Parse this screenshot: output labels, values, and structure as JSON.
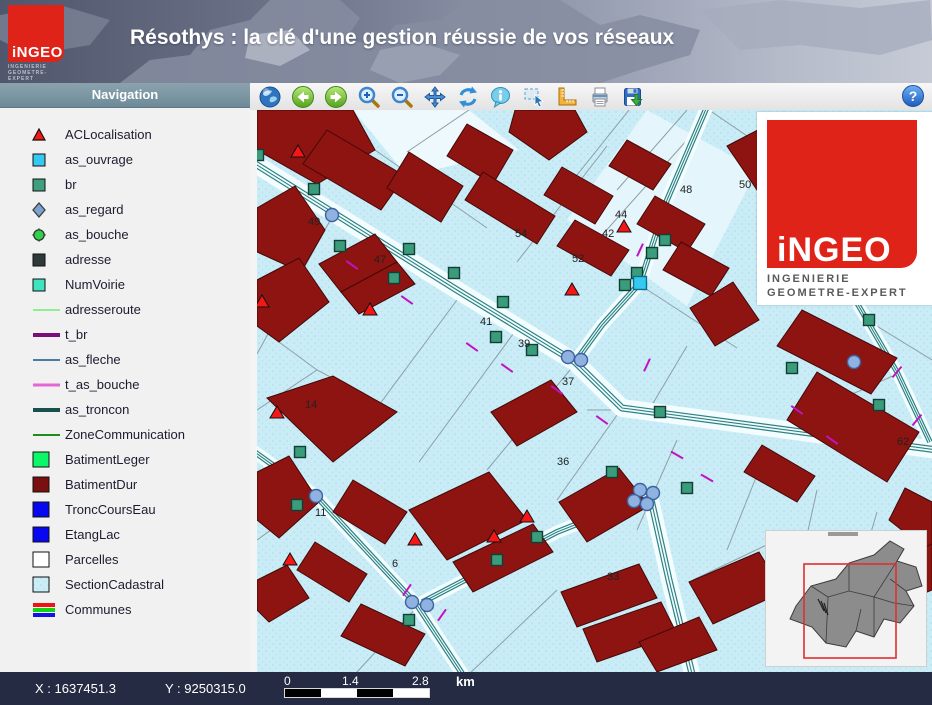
{
  "header": {
    "title": "Résothys : la clé d'une gestion réussie de vos réseaux",
    "logo": {
      "name": "iNGEO",
      "subline1": "INGENIERIE",
      "subline2": "GEOMETRE-EXPERT"
    }
  },
  "sidebar": {
    "title": "Navigation",
    "items": [
      {
        "label": "ACLocalisation",
        "icon": "triangle-red"
      },
      {
        "label": "as_ouvrage",
        "icon": "square-cyan"
      },
      {
        "label": "br",
        "icon": "square-teal"
      },
      {
        "label": "as_regard",
        "icon": "diamond-steelblue"
      },
      {
        "label": "as_bouche",
        "icon": "node-green"
      },
      {
        "label": "adresse",
        "icon": "square-darkgray"
      },
      {
        "label": "NumVoirie",
        "icon": "square-turquoise"
      },
      {
        "label": "adresseroute",
        "icon": "line-lightgreen"
      },
      {
        "label": "t_br",
        "icon": "line-purple"
      },
      {
        "label": "as_fleche",
        "icon": "line-steelblue"
      },
      {
        "label": "t_as_bouche",
        "icon": "line-pink"
      },
      {
        "label": "as_troncon",
        "icon": "line-darkteal"
      },
      {
        "label": "ZoneCommunication",
        "icon": "line-green"
      },
      {
        "label": "BatimentLeger",
        "icon": "square-brightgreen"
      },
      {
        "label": "BatimentDur",
        "icon": "square-darkred"
      },
      {
        "label": "TroncCoursEau",
        "icon": "square-blue"
      },
      {
        "label": "EtangLac",
        "icon": "square-blue"
      },
      {
        "label": "Parcelles",
        "icon": "square-white"
      },
      {
        "label": "SectionCadastral",
        "icon": "square-stipple"
      },
      {
        "label": "Communes",
        "icon": "stripes-rgb"
      }
    ]
  },
  "toolbar": {
    "buttons": [
      {
        "name": "globe"
      },
      {
        "name": "back"
      },
      {
        "name": "forward"
      },
      {
        "name": "zoom-in"
      },
      {
        "name": "zoom-out"
      },
      {
        "name": "pan"
      },
      {
        "name": "refresh"
      },
      {
        "name": "info"
      },
      {
        "name": "select"
      },
      {
        "name": "measure"
      },
      {
        "name": "print"
      },
      {
        "name": "save"
      }
    ],
    "help": {
      "name": "help",
      "glyph": "?"
    }
  },
  "map": {
    "logo_overlay": {
      "name": "iNGEO",
      "subline1": "INGENIERIE",
      "subline2": "GEOMETRE-EXPERT"
    },
    "colors": {
      "background": "#c9ecf6",
      "stipple": "#a8dcea",
      "building": "#8d1411",
      "building_edge": "#430808",
      "parcel": "#8f9ea6",
      "road_fill": "#f3fcfe",
      "road_line": "#2b8282",
      "tick": "#c213c3",
      "br_square": "#3b9c7c",
      "regard_circle": "#8fb2e0",
      "triangle": "#f51616",
      "ouvrage": "#35c9ef",
      "label": "#222222"
    },
    "roads": [
      {
        "d": "M-8,50 L200,180 L318,252 L365,298 L680,340",
        "w": 18
      },
      {
        "d": "M452,-8 L410,90 L383,173 L345,215 L318,252",
        "w": 13
      },
      {
        "d": "M393,385 L412,470 L436,568",
        "w": 16
      },
      {
        "d": "M393,385 L300,422 L160,495",
        "w": 13
      },
      {
        "d": "M-8,338 L59,386 L160,495 L208,568",
        "w": 13
      },
      {
        "d": "M600,193 L640,262 L673,332",
        "w": 12
      }
    ],
    "parcels": [
      "M150,42 L212,0",
      "M260,152 L350,36",
      "M330,142 L430,30",
      "M300,90 L372,0",
      "M430,0 L360,80",
      "M75,107 L0,244",
      "M200,190 L96,330",
      "M262,216 L162,352",
      "M318,254 L230,360",
      "M365,298 L300,390",
      "M420,330 L380,420",
      "M500,365 L470,440",
      "M560,380 L540,470",
      "M620,402 L600,470",
      "M452,0 L540,60 L600,190",
      "M383,175 L480,238",
      "M430,236 L392,300 L330,300",
      "M0,300 L60,260",
      "M160,497 L100,562",
      "M208,568 L300,480",
      "M436,470 L520,430",
      "M59,388 L0,430",
      "M675,250 L610,210",
      "M640,264 L560,300",
      "M500,80 L560,120 L600,193",
      "M118,40 L230,118",
      "M22,232 L60,260 L140,302"
    ],
    "buildings": [
      "0,0 96,0 118,40 60,74 0,40",
      "70,20 148,66 124,100 46,54",
      "152,42 206,76 184,112 130,78",
      "210,14 256,40 236,74 190,46",
      "226,62 298,106 280,134 208,90",
      "258,0 318,0 330,22 292,50 252,22",
      "305,57 356,86 338,114 287,85",
      "318,110 372,140 354,166 300,136",
      "370,30 414,54 396,80 352,56",
      "398,86 448,114 430,142 380,114",
      "424,132 472,158 454,186 406,160",
      "470,36 520,10 548,52 500,80",
      "433,198 476,172 502,210 458,236",
      "545,200 640,248 614,284 520,236",
      "560,262 662,322 630,372 530,310",
      "648,378 675,392 675,444 632,410",
      "505,335 558,366 540,392 487,362",
      "0,98 38,76 68,120 44,162 0,142",
      "0,170 42,148 72,192 22,232 0,216",
      "62,154 118,124 140,152 84,182",
      "84,182 140,152 158,174 102,204",
      "10,288 76,266 140,302 76,352",
      "0,362 32,346 62,392 22,428 0,410",
      "96,370 150,402 128,434 76,402",
      "58,432 110,464 92,492 40,460",
      "104,494 168,524 148,556 84,526",
      "152,400 232,362 270,410 190,450",
      "196,452 276,414 296,442 216,482",
      "234,302 294,270 320,302 260,336",
      "302,392 362,358 392,396 330,432",
      "304,482 382,454 400,488 320,517",
      "326,519 404,492 420,524 340,552",
      "432,472 502,442 526,482 456,514",
      "522,502 602,472 624,510 544,542",
      "622,457 675,434 675,480 642,494",
      "382,532 442,507 460,540 400,562",
      "0,470 30,455 52,488 12,512 0,500"
    ],
    "ticks": [
      [
        95,
        155,
        -55
      ],
      [
        150,
        190,
        -55
      ],
      [
        215,
        237,
        -55
      ],
      [
        250,
        258,
        -55
      ],
      [
        300,
        280,
        -55
      ],
      [
        345,
        310,
        -55
      ],
      [
        383,
        140,
        25
      ],
      [
        390,
        255,
        25
      ],
      [
        420,
        345,
        -60
      ],
      [
        450,
        368,
        -60
      ],
      [
        660,
        310,
        40
      ],
      [
        640,
        262,
        40
      ],
      [
        150,
        480,
        35
      ],
      [
        185,
        505,
        35
      ],
      [
        540,
        300,
        -55
      ],
      [
        575,
        330,
        -55
      ]
    ],
    "markers": {
      "triangles": [
        [
          41,
          42
        ],
        [
          5,
          192
        ],
        [
          113,
          200
        ],
        [
          315,
          180
        ],
        [
          367,
          117
        ],
        [
          20,
          303
        ],
        [
          33,
          450
        ],
        [
          158,
          430
        ],
        [
          237,
          427
        ],
        [
          270,
          407
        ]
      ],
      "br_squares": [
        [
          1,
          45
        ],
        [
          57,
          79
        ],
        [
          83,
          136
        ],
        [
          152,
          139
        ],
        [
          137,
          168
        ],
        [
          197,
          163
        ],
        [
          246,
          192
        ],
        [
          239,
          227
        ],
        [
          275,
          240
        ],
        [
          408,
          130
        ],
        [
          395,
          143
        ],
        [
          380,
          163
        ],
        [
          368,
          175
        ],
        [
          612,
          210
        ],
        [
          535,
          258
        ],
        [
          43,
          342
        ],
        [
          40,
          395
        ],
        [
          152,
          510
        ],
        [
          240,
          450
        ],
        [
          280,
          427
        ],
        [
          355,
          362
        ],
        [
          430,
          378
        ],
        [
          622,
          295
        ],
        [
          403,
          302
        ]
      ],
      "regards": [
        [
          75,
          105
        ],
        [
          311,
          247
        ],
        [
          324,
          250
        ],
        [
          59,
          386
        ],
        [
          155,
          492
        ],
        [
          170,
          495
        ],
        [
          383,
          380
        ],
        [
          396,
          383
        ],
        [
          377,
          391
        ],
        [
          390,
          394
        ],
        [
          597,
          252
        ]
      ],
      "ouvrage": [
        [
          383,
          173
        ]
      ]
    },
    "labels": [
      [
        "49",
        51,
        115
      ],
      [
        "47",
        117,
        153
      ],
      [
        "41",
        223,
        215
      ],
      [
        "52",
        315,
        152
      ],
      [
        "54",
        258,
        127
      ],
      [
        "48",
        423,
        83
      ],
      [
        "50",
        482,
        78
      ],
      [
        "44",
        358,
        108
      ],
      [
        "42",
        345,
        127
      ],
      [
        "39",
        261,
        237
      ],
      [
        "37",
        305,
        275
      ],
      [
        "36",
        300,
        355
      ],
      [
        "33",
        350,
        470
      ],
      [
        "11",
        58,
        406
      ],
      [
        "14",
        48,
        298
      ],
      [
        "6",
        135,
        457
      ],
      [
        "62",
        640,
        335
      ]
    ]
  },
  "statusbar": {
    "x_label": "X : 1637451.3",
    "y_label": "Y : 9250315.0",
    "scale": {
      "t0": "0",
      "t1": "1.4",
      "t2": "2.8",
      "unit": "km"
    }
  }
}
